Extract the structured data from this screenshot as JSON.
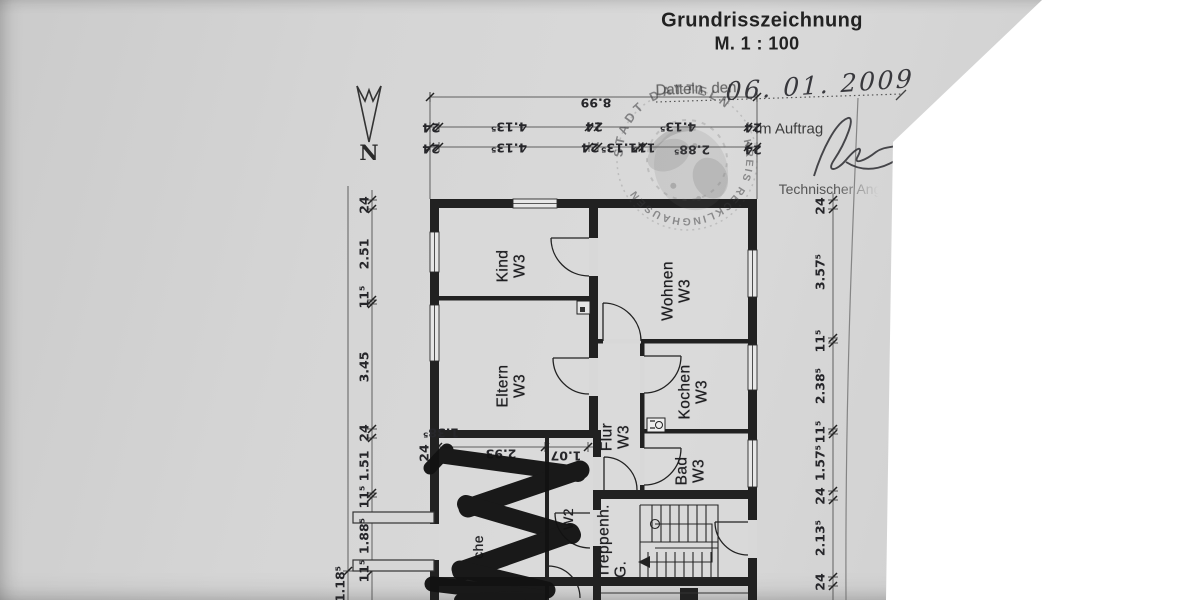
{
  "header": {
    "title": "Grundrisszeichnung",
    "scale": "M. 1 : 100"
  },
  "form": {
    "date_label": "Datteln, den",
    "date_value": "06. 01. 2009",
    "order_label": "Im Auftrag",
    "role_label": "Technischer Ang",
    "north_label": "N"
  },
  "stamp": {
    "top_text": "STADT DATTELN",
    "bottom_text": "KREIS RECKLINGHAUSEN"
  },
  "rooms": {
    "kind": {
      "name": "Kind",
      "unit": "W3"
    },
    "wohnen": {
      "name": "Wohnen",
      "unit": "W3"
    },
    "eltern": {
      "name": "Eltern",
      "unit": "W3"
    },
    "kochen": {
      "name": "Kochen",
      "unit": "W3"
    },
    "flur": {
      "name": "Flur",
      "unit": "W3"
    },
    "bad": {
      "name": "Bad",
      "unit": "W3"
    },
    "treppenhaus": {
      "name": "Treppenh.",
      "unit": "G."
    },
    "redacted": {
      "name": "che",
      "unit": "W2"
    }
  },
  "dimensions": {
    "top_overall": "8.99",
    "top_row2": [
      "24",
      "4.13⁵",
      "24",
      "4.13⁵",
      "24"
    ],
    "top_row3": [
      "24",
      "4.13⁵",
      "24",
      "1.13⁵",
      "11⁵",
      "2.88⁵",
      "24"
    ],
    "left": [
      "24",
      "2.51",
      "11⁵",
      "3.45",
      "24",
      "1.51",
      "11⁵",
      "1.88⁵",
      "11⁵"
    ],
    "left_outer": "1.18⁵",
    "right": [
      "24",
      "3.57⁵",
      "11⁵",
      "2.38⁵",
      "11⁵",
      "1.57⁵",
      "24",
      "2.13⁵",
      "24"
    ],
    "inner_row": [
      "2.93",
      "1.07"
    ],
    "inner_left": "1.38⁵",
    "inner_wall": "24"
  },
  "colors": {
    "ink": "#222222",
    "paper": "#d4d4d4",
    "redaction": "#121212"
  }
}
